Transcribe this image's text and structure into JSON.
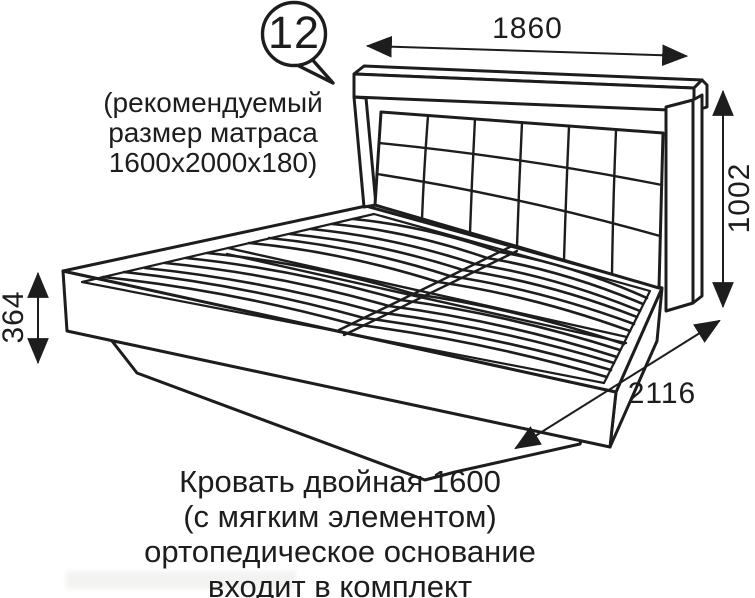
{
  "diagram": {
    "callout": {
      "number": "12"
    },
    "mattress_note": {
      "line1": "(рекомендуемый",
      "line2": "размер матраса",
      "line3": "1600х2000х180)"
    },
    "dimensions": {
      "headboard_width": "1860",
      "headboard_height": "1002",
      "frame_height": "364",
      "bed_length": "2116"
    },
    "caption": {
      "line1": "Кровать двойная 1600",
      "line2": "(с мягким элементом)",
      "line3": "ортопедическое основание",
      "line4": "входит в комплект"
    },
    "colors": {
      "line": "#1d1d1d",
      "text": "#1d1d1d",
      "background": "#ffffff"
    }
  }
}
